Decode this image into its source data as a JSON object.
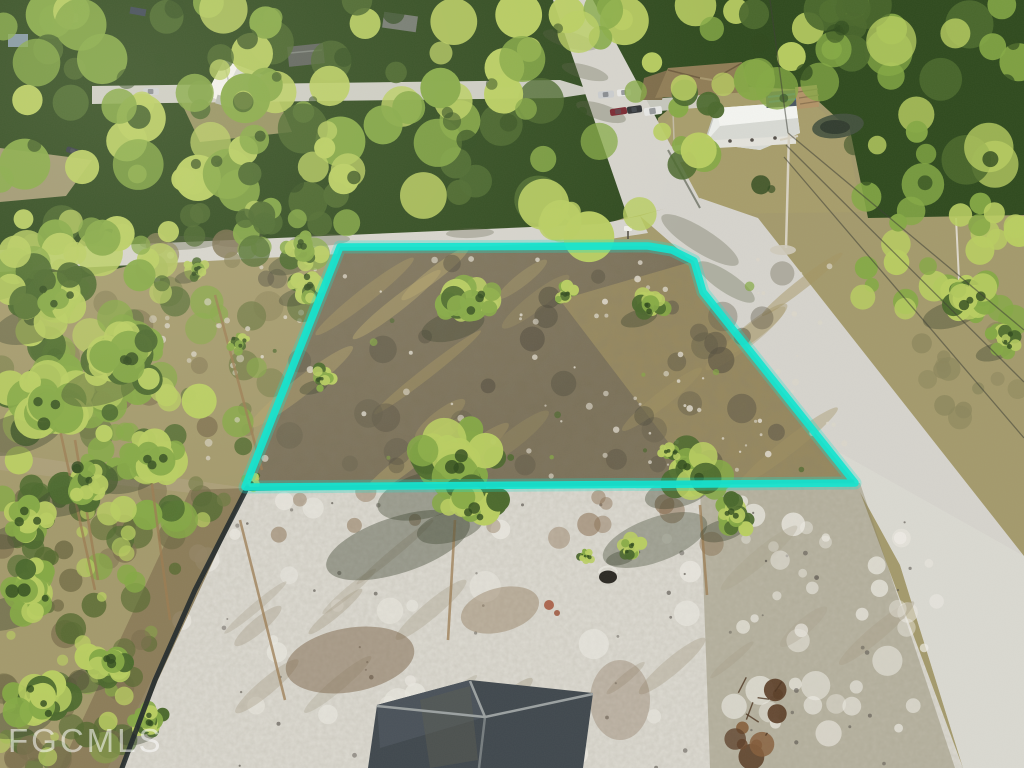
{
  "meta": {
    "type": "aerial-drone-photo",
    "description": "Aerial drone photo of a vacant residential lot outlined with a bright cyan property-boundary overlay at a concrete road intersection, surrounded by pine flatwoods, houses along the top street, a silt fence and a cleared sandy homesite with a dark shingled roof under construction at the bottom, FGCMLS watermark bottom-left."
  },
  "watermark": {
    "text": "FGCMLS"
  },
  "colors": {
    "brush_base": "#a49a6c",
    "canopy_bright": "#b9ce61",
    "canopy_mid": "#85a945",
    "canopy_dark": "#4b692d",
    "canopy_deep": "#2f4a1e",
    "lot_base": "#7b7158",
    "lot_tan": "#b3a264",
    "sand": "#cfccc2",
    "sand_olive": "#8b8569",
    "road": "#d6d4cd",
    "road_bright": "#dfddd6",
    "lawn": "#a79d6b",
    "dirt": "#8a7a58",
    "fence": "#232a2b",
    "boundary_cyan": "#16e4cf",
    "roof_construction": "#40484e",
    "roof_ridge": "#9ba1a1",
    "house_white": "#eceeea",
    "roof_brown": "#8f7c55",
    "pond": "#45523f",
    "wire": "#3c3e34",
    "trunk": "#9c7c52",
    "watermark_white": "#ffffff"
  }
}
